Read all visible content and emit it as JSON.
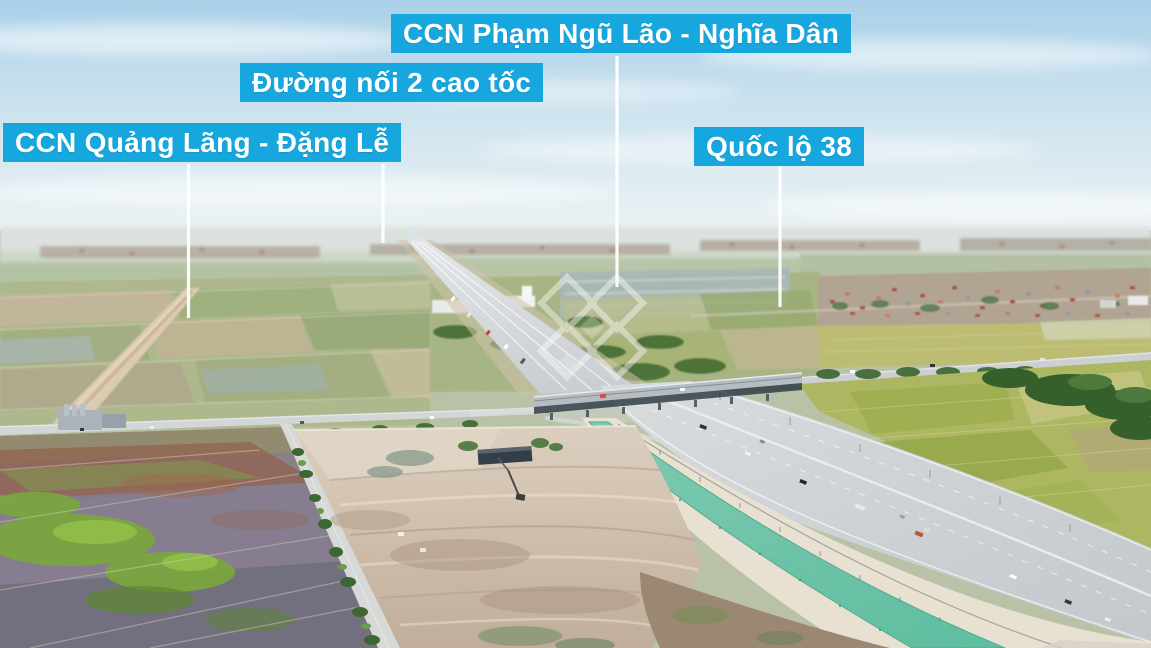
{
  "annotations": {
    "label_bg_color": "#17a7df",
    "label_text_color": "#ffffff",
    "leader_line_color": "#ffffff",
    "labels": [
      {
        "id": "ccn-pham-ngu-lao-nghia-dan",
        "text": "CCN Phạm Ngũ Lão - Nghĩa Dân"
      },
      {
        "id": "duong-noi-2-cao-toc",
        "text": "Đường nối 2 cao tốc"
      },
      {
        "id": "ccn-quang-lang-dang-le",
        "text": "CCN Quảng Lãng - Đặng Lễ"
      },
      {
        "id": "quoc-lo-38",
        "text": "Quốc lộ 38"
      }
    ],
    "watermark": {
      "shape": "diamond-lattice-logo",
      "color": "#ffffff"
    }
  }
}
